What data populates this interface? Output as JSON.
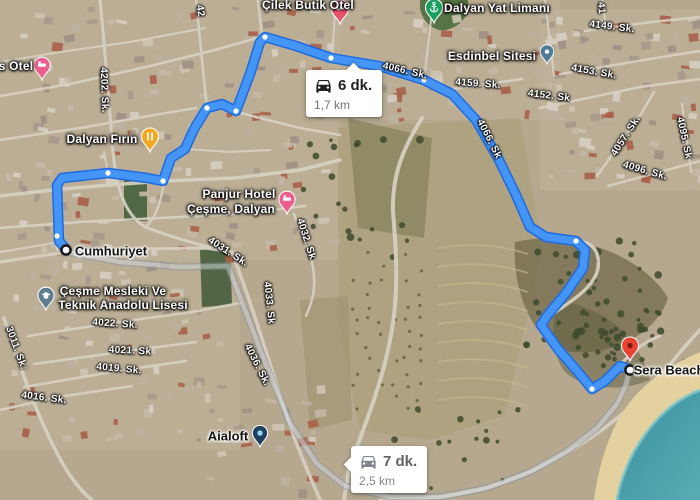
{
  "app": {
    "name": "Google Maps",
    "view": "satellite directions"
  },
  "colors": {
    "route_primary": "#4595f6",
    "route_primary_casing": "#1e6ae0",
    "route_alternate": "#ccd2d8",
    "route_alternate_casing": "#8792a0",
    "sea": "#39919f",
    "sand": "#e3d2a0",
    "destination_red": "#ea4335"
  },
  "info_boxes": {
    "primary": {
      "time": "6 dk.",
      "distance": "1,7 km"
    },
    "alternate": {
      "time": "7 dk.",
      "distance": "2,5 km"
    }
  },
  "route": {
    "main_points": [
      [
        66,
        249
      ],
      [
        59,
        241
      ],
      [
        57,
        185
      ],
      [
        62,
        178
      ],
      [
        108,
        173
      ],
      [
        147,
        178
      ],
      [
        163,
        181
      ],
      [
        171,
        158
      ],
      [
        185,
        149
      ],
      [
        194,
        129
      ],
      [
        207,
        108
      ],
      [
        222,
        104
      ],
      [
        236,
        111
      ],
      [
        250,
        74
      ],
      [
        260,
        42
      ],
      [
        265,
        37
      ],
      [
        296,
        46
      ],
      [
        331,
        58
      ],
      [
        379,
        66
      ],
      [
        424,
        80
      ],
      [
        452,
        94
      ],
      [
        476,
        120
      ],
      [
        498,
        158
      ],
      [
        516,
        195
      ],
      [
        530,
        227
      ],
      [
        546,
        237
      ],
      [
        576,
        241
      ],
      [
        585,
        250
      ],
      [
        583,
        268
      ],
      [
        566,
        293
      ],
      [
        547,
        316
      ],
      [
        541,
        325
      ],
      [
        558,
        349
      ],
      [
        578,
        372
      ],
      [
        592,
        389
      ],
      [
        605,
        381
      ],
      [
        620,
        366
      ],
      [
        629,
        369
      ]
    ],
    "alt_points": [
      [
        66,
        252
      ],
      [
        120,
        262
      ],
      [
        180,
        267
      ],
      [
        228,
        266
      ],
      [
        247,
        315
      ],
      [
        266,
        365
      ],
      [
        290,
        423
      ],
      [
        317,
        464
      ],
      [
        345,
        486
      ],
      [
        390,
        497
      ],
      [
        440,
        497
      ],
      [
        487,
        488
      ],
      [
        530,
        472
      ],
      [
        567,
        451
      ],
      [
        597,
        428
      ],
      [
        617,
        404
      ],
      [
        626,
        385
      ],
      [
        629,
        372
      ]
    ],
    "waypoints": [
      [
        57,
        236
      ],
      [
        108,
        173
      ],
      [
        163,
        181
      ],
      [
        207,
        108
      ],
      [
        236,
        111
      ],
      [
        265,
        37
      ],
      [
        331,
        58
      ],
      [
        424,
        80
      ],
      [
        576,
        241
      ],
      [
        592,
        389
      ]
    ]
  },
  "labels": [
    {
      "text": "Çilek Butik Otel",
      "type": "poi",
      "x": 308,
      "y": 5,
      "rot": 0
    },
    {
      "text": "Dalyan Yat Limanı",
      "type": "poi",
      "x": 497,
      "y": 8,
      "rot": 0
    },
    {
      "text": "s Otel",
      "type": "poi",
      "x": 16,
      "y": 66,
      "rot": 0
    },
    {
      "text": "Dalyan Fırın",
      "type": "poi",
      "x": 102,
      "y": 139,
      "rot": 0
    },
    {
      "text": "Esdinbel Sitesi",
      "type": "poi",
      "x": 492,
      "y": 56,
      "rot": 0
    },
    {
      "text": "Panjur Hotel",
      "type": "poi",
      "x": 239,
      "y": 194,
      "rot": 0
    },
    {
      "text": "Çeşme, Dalyan",
      "type": "poi",
      "x": 231,
      "y": 209,
      "rot": 0
    },
    {
      "text": "Cumhuriyet",
      "type": "place",
      "x": 111,
      "y": 251,
      "rot": 0
    },
    {
      "text": "Çeşme Mesleki Ve",
      "type": "poi",
      "x": 113,
      "y": 291,
      "rot": 0
    },
    {
      "text": "Teknik Anadolu Lisesi",
      "type": "poi",
      "x": 123,
      "y": 305,
      "rot": 0
    },
    {
      "text": "Aialoft",
      "type": "place",
      "x": 228,
      "y": 436,
      "rot": 0
    },
    {
      "text": "Sera Beach",
      "type": "place",
      "x": 669,
      "y": 370,
      "rot": 0
    },
    {
      "text": "4202. Sk.",
      "type": "street",
      "x": 104,
      "y": 90,
      "rot": 88
    },
    {
      "text": "42",
      "type": "street",
      "x": 200,
      "y": 11,
      "rot": 80
    },
    {
      "text": "41",
      "type": "street",
      "x": 601,
      "y": 8,
      "rot": 85
    },
    {
      "text": "4149. Sk.",
      "type": "street",
      "x": 612,
      "y": 27,
      "rot": 7
    },
    {
      "text": "4153. Sk.",
      "type": "street",
      "x": 594,
      "y": 72,
      "rot": 10
    },
    {
      "text": "4152. Sk",
      "type": "street",
      "x": 549,
      "y": 96,
      "rot": 7
    },
    {
      "text": "4159. Sk.",
      "type": "street",
      "x": 478,
      "y": 84,
      "rot": 4
    },
    {
      "text": "4066. Sk.",
      "type": "street",
      "x": 405,
      "y": 71,
      "rot": 13
    },
    {
      "text": "4066. Sk",
      "type": "street",
      "x": 489,
      "y": 139,
      "rot": 63
    },
    {
      "text": "4057. Sk.",
      "type": "street",
      "x": 626,
      "y": 136,
      "rot": -57
    },
    {
      "text": "4095. Sk",
      "type": "street",
      "x": 684,
      "y": 138,
      "rot": 78
    },
    {
      "text": "4096. Sk.",
      "type": "street",
      "x": 645,
      "y": 171,
      "rot": 16
    },
    {
      "text": "4031. Sk.",
      "type": "street",
      "x": 228,
      "y": 252,
      "rot": 33
    },
    {
      "text": "4032. Sk",
      "type": "street",
      "x": 306,
      "y": 239,
      "rot": 72
    },
    {
      "text": "4033. Sk",
      "type": "street",
      "x": 269,
      "y": 303,
      "rot": 84
    },
    {
      "text": "4036. Sk.",
      "type": "street",
      "x": 257,
      "y": 365,
      "rot": 63
    },
    {
      "text": "4022. Sk.",
      "type": "street",
      "x": 115,
      "y": 324,
      "rot": 4
    },
    {
      "text": "4021. Sk",
      "type": "street",
      "x": 130,
      "y": 351,
      "rot": 3
    },
    {
      "text": "4019. Sk.",
      "type": "street",
      "x": 119,
      "y": 369,
      "rot": 5
    },
    {
      "text": "4016. Sk.",
      "type": "street",
      "x": 44,
      "y": 398,
      "rot": 7
    },
    {
      "text": "3011. Sk.",
      "type": "street",
      "x": 16,
      "y": 348,
      "rot": 70
    }
  ],
  "markers": [
    {
      "name": "hotel-pin-left",
      "label": "s Otel",
      "kind": "pin",
      "icon": "lodging",
      "color": "#ee5e8d",
      "x": 42,
      "y": 80,
      "s": 0.95
    },
    {
      "name": "cilek-butik-otel-pin",
      "label": "Çilek Butik Otel",
      "kind": "pin",
      "icon": "lodging",
      "color": "#e8506b",
      "x": 340,
      "y": 24,
      "s": 1
    },
    {
      "name": "dalyan-firin-pin",
      "label": "Dalyan Fırın",
      "kind": "pin",
      "icon": "restaurant",
      "color": "#f4a722",
      "x": 150,
      "y": 152,
      "s": 1
    },
    {
      "name": "dalyan-yat-limani-pin",
      "label": "Dalyan Yat Limanı",
      "kind": "pin",
      "icon": "anchor",
      "color": "#18a05e",
      "x": 434,
      "y": 23,
      "s": 1
    },
    {
      "name": "esdinbel-sitesi-pin",
      "label": "Esdinbel Sitesi",
      "kind": "pin",
      "icon": "dot",
      "color": "#4d7d95",
      "x": 547,
      "y": 64,
      "s": 0.8
    },
    {
      "name": "panjur-hotel-pin",
      "label": "Panjur Hotel Çeşme, Dalyan",
      "kind": "pin",
      "icon": "lodging",
      "color": "#ee5e8d",
      "x": 287,
      "y": 214,
      "s": 0.95
    },
    {
      "name": "school-pin",
      "label": "Çeşme Mesleki Ve Teknik Anadolu Lisesi",
      "kind": "pin",
      "icon": "school",
      "color": "#5e7d8e",
      "x": 46,
      "y": 310,
      "s": 0.95
    },
    {
      "name": "aialoft-pin",
      "label": "Aialoft",
      "kind": "pin",
      "icon": "cyan-dot",
      "color": "#20415f",
      "x": 260,
      "y": 447,
      "s": 0.9
    },
    {
      "name": "sera-beach-destination-pin",
      "label": "Sera Beach",
      "kind": "pin",
      "icon": "hole",
      "color": "#ea4335",
      "x": 630,
      "y": 361,
      "s": 1
    },
    {
      "name": "route-origin-marker",
      "kind": "ring",
      "x": 66,
      "y": 250
    },
    {
      "name": "route-destination-marker",
      "kind": "ring",
      "x": 630,
      "y": 370
    }
  ]
}
